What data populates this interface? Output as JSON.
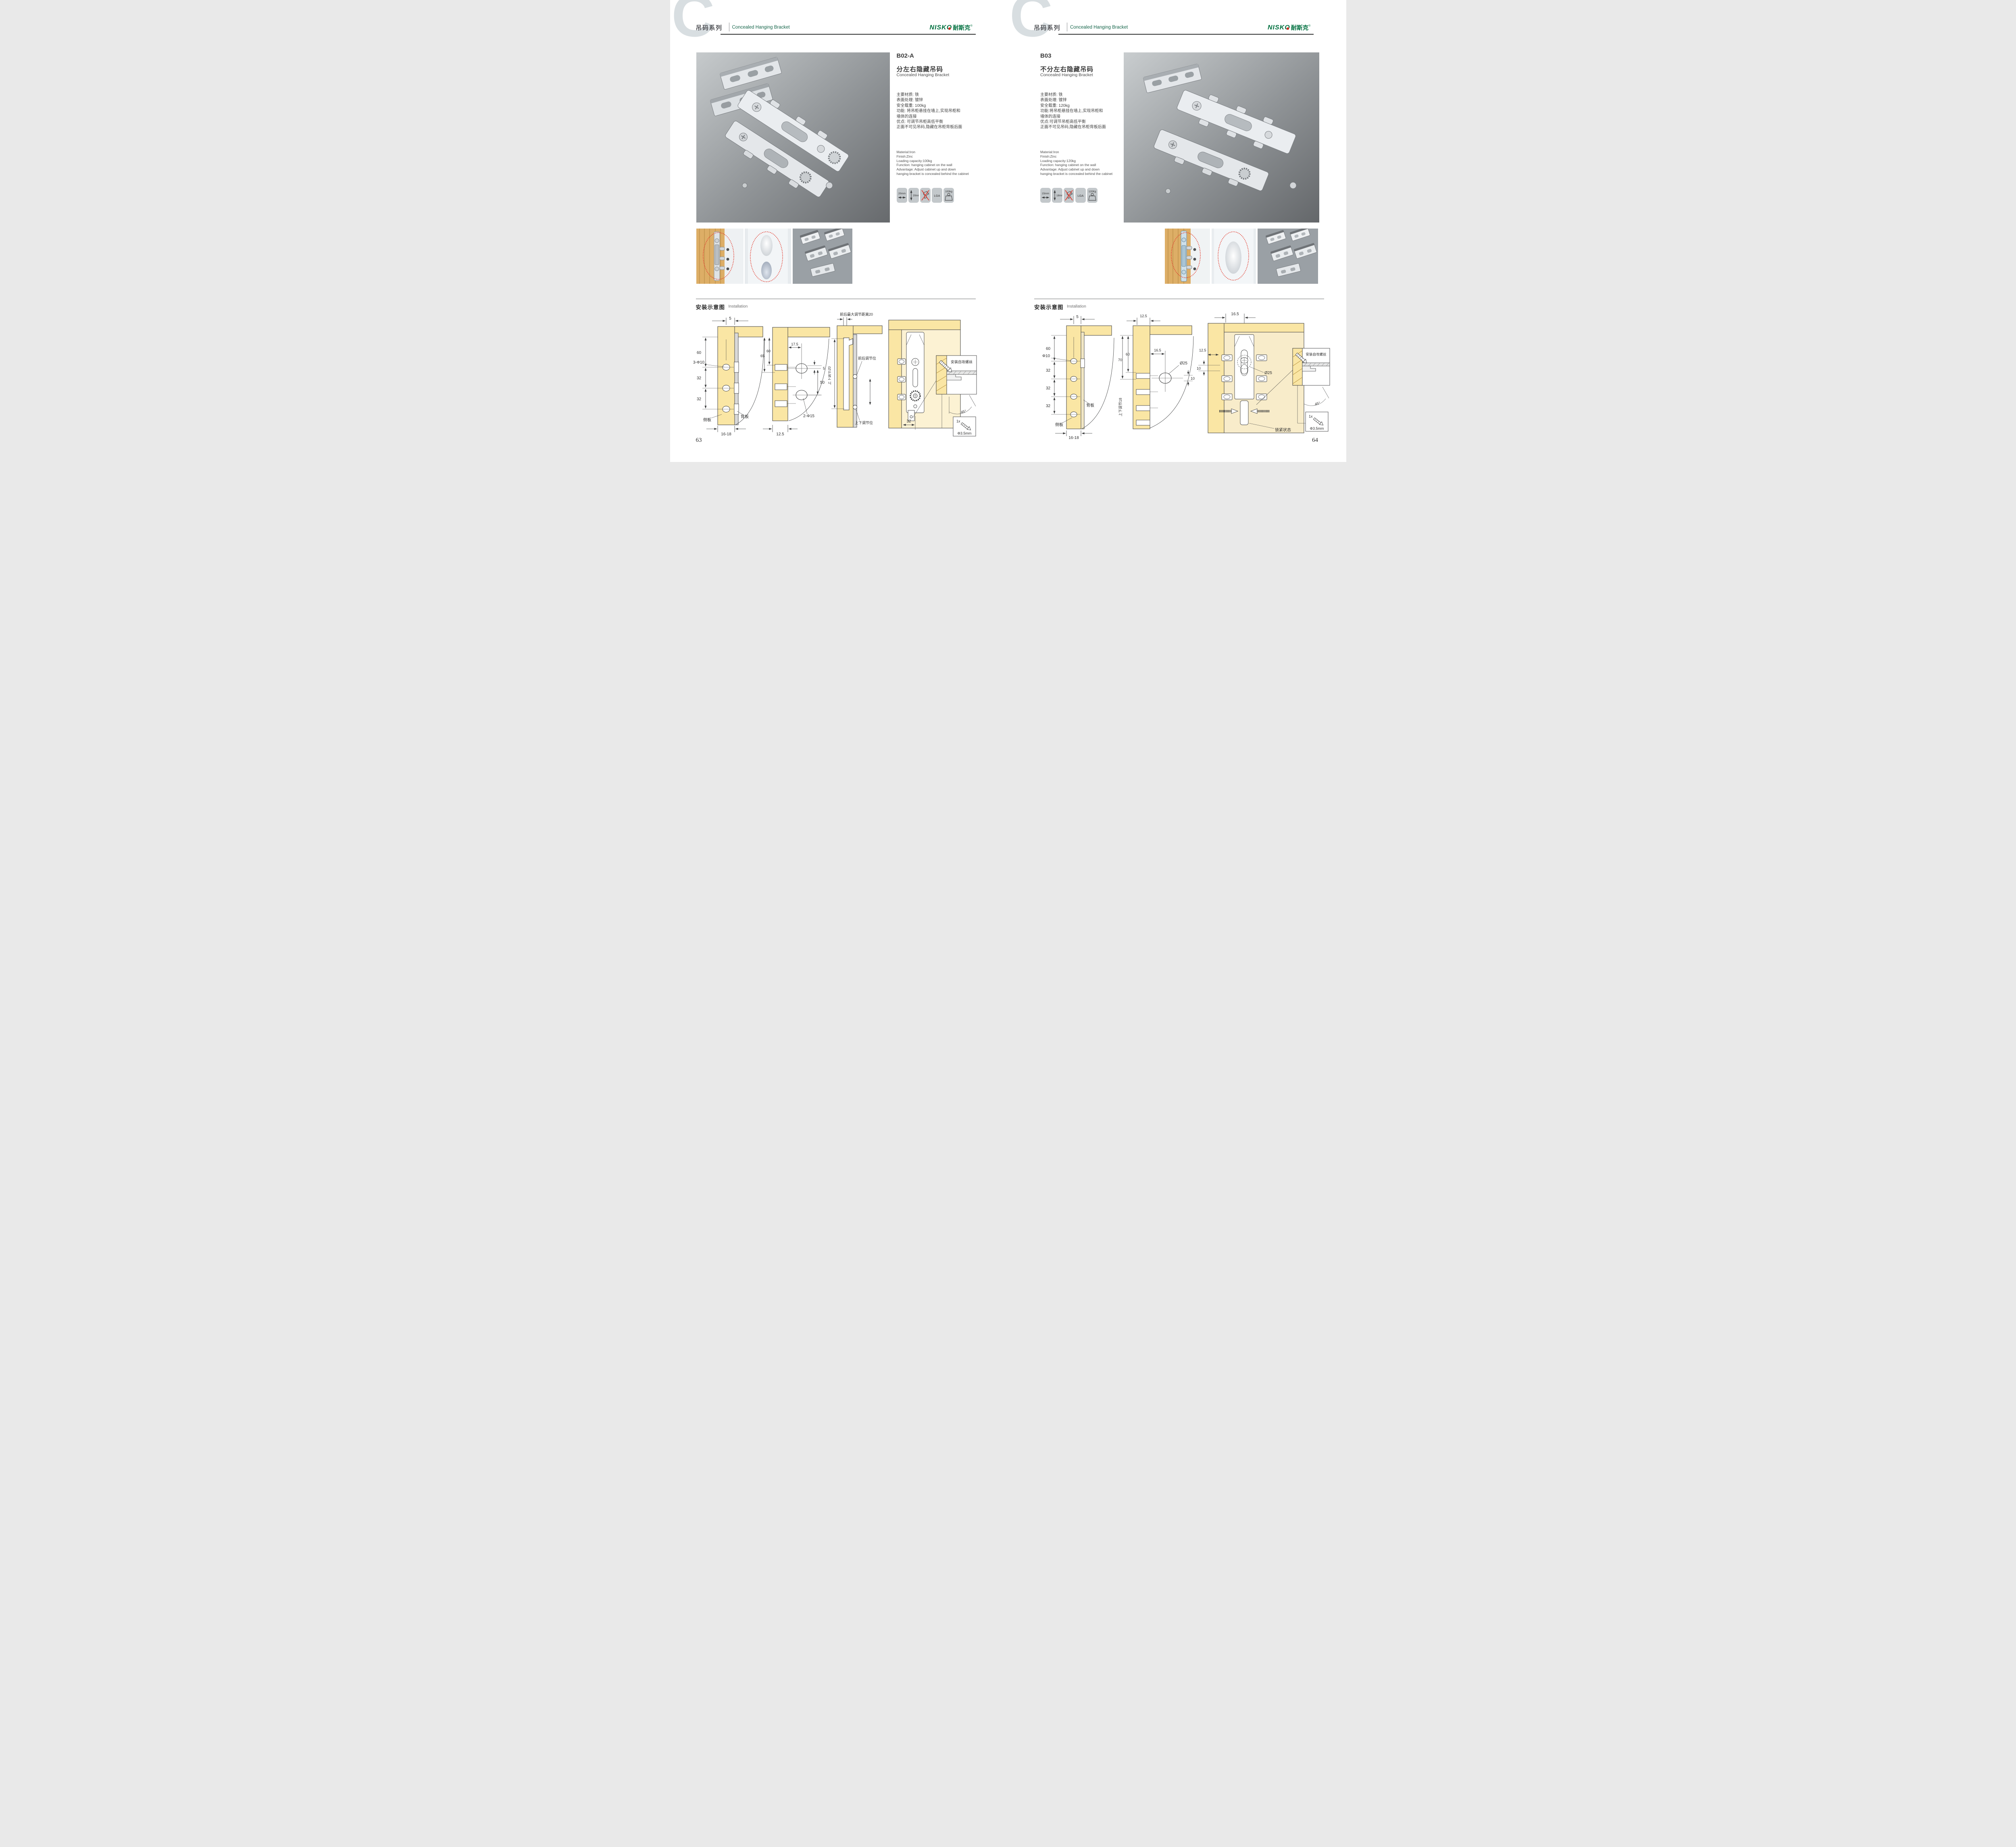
{
  "header": {
    "watermark": "C",
    "series_cn": "吊码系列",
    "series_en": "Concealed Hanging Bracket",
    "brand_latin": "NISKO",
    "brand_cn": "耐斯克",
    "brand_reg": "®"
  },
  "installation": {
    "title_cn": "安装示意图",
    "title_en": "Installation"
  },
  "page_left": {
    "page_number": "63",
    "product": {
      "model": "B02-A",
      "name_cn": "分左右隐藏吊码",
      "name_en": "Concealed Hanging Bracket",
      "specs_cn": [
        "主要材质: 铁",
        "表面处理: 镀锌",
        "安全载重: 100kg",
        "功能: 将吊柜悬挂在墙上,实现吊柜和",
        "墙体的连接",
        "优点: 可调节吊柜高低平衡",
        "正面不可见吊码,隐藏在吊柜背板后面"
      ],
      "specs_en": [
        "Material:Iron",
        "Finish:Zinc",
        "Loading capacity:100kg",
        "Function: hanging cabinet on the wall",
        "Advantage: Adjust cabinet up and down",
        "hanging bracket is concealed behind the cabinet"
      ],
      "icons": [
        {
          "name": "width-adjust",
          "label": "20mm"
        },
        {
          "name": "height-adjust",
          "label": "20mm"
        },
        {
          "name": "no-drill",
          "label": ""
        },
        {
          "name": "certificate",
          "label": "LGA"
        },
        {
          "name": "load-capacity",
          "label": "100kg"
        }
      ]
    },
    "diagrams": {
      "d1": {
        "dim_top": "5",
        "dim_60": "60",
        "hole_label": "3-Φ10",
        "dim_32a": "32",
        "dim_32b": "32",
        "side_panel": "侧板",
        "back_panel": "背板",
        "dim_bottom": "16-18"
      },
      "d2": {
        "dim_65": "65",
        "dim_60": "60",
        "dim_17_5": "17.5",
        "dim_5": "5",
        "dim_50": "50",
        "hole_label": "2-Φ15",
        "dim_bottom": "12.5"
      },
      "d3": {
        "title": "前后最大调节距离20",
        "vertical": "上下调节20",
        "callout_front": "前后调节位",
        "callout_updown": "上下调节位"
      },
      "d4": {
        "dim_32": "32",
        "callout": "安装自攻螺丝",
        "angle": "45°",
        "qty": "1x",
        "screw": "Φ3.5mm"
      }
    }
  },
  "page_right": {
    "page_number": "64",
    "product": {
      "model": "B03",
      "name_cn": "不分左右隐藏吊码",
      "name_en": "Concealed Hanging Bracket",
      "specs_cn": [
        "主要材质: 铁",
        "表面处理: 镀锌",
        "安全载重: 120kg",
        "功能:将吊柜悬挂在墙上,实现吊柜和",
        "墙体的连接",
        "优点:可调节吊柜高低平衡",
        "正面不可见吊码,隐藏在吊柜背板后面"
      ],
      "specs_en": [
        "Material:Iron",
        "Finish:Zinc",
        "Loading capacity:120kg",
        "Function: hanging cabinet on the wall",
        "Advantage: Adjust cabinet up and down",
        "hanging bracket is concealed behind the cabinet"
      ],
      "icons": [
        {
          "name": "width-adjust",
          "label": "15mm"
        },
        {
          "name": "height-adjust",
          "label": "18mm"
        },
        {
          "name": "no-drill",
          "label": ""
        },
        {
          "name": "certificate",
          "label": "LGA"
        },
        {
          "name": "load-capacity",
          "label": "120Kg"
        }
      ]
    },
    "diagrams": {
      "d1": {
        "dim_top": "5",
        "dim_60": "60",
        "hole_label": "Φ10",
        "dim_32a": "32",
        "dim_32b": "32",
        "dim_32c": "32",
        "side_panel": "侧板",
        "back_panel": "背板",
        "dim_bottom": "16-18"
      },
      "d2": {
        "dim_top": "12.5",
        "dim_70": "70",
        "dim_60": "60",
        "dim_16_5": "16.5",
        "hole_label": "Ø25",
        "dim_10": "10",
        "vertical": "上下调节18"
      },
      "d3": {
        "dim_top": "16.5",
        "dim_12_5": "12.5",
        "dim_10": "10",
        "hole_label": "Ø25",
        "state": "锁紧状态",
        "callout": "安装自攻螺丝",
        "angle": "45°",
        "qty": "1x",
        "screw": "Φ3.5mm"
      }
    }
  }
}
